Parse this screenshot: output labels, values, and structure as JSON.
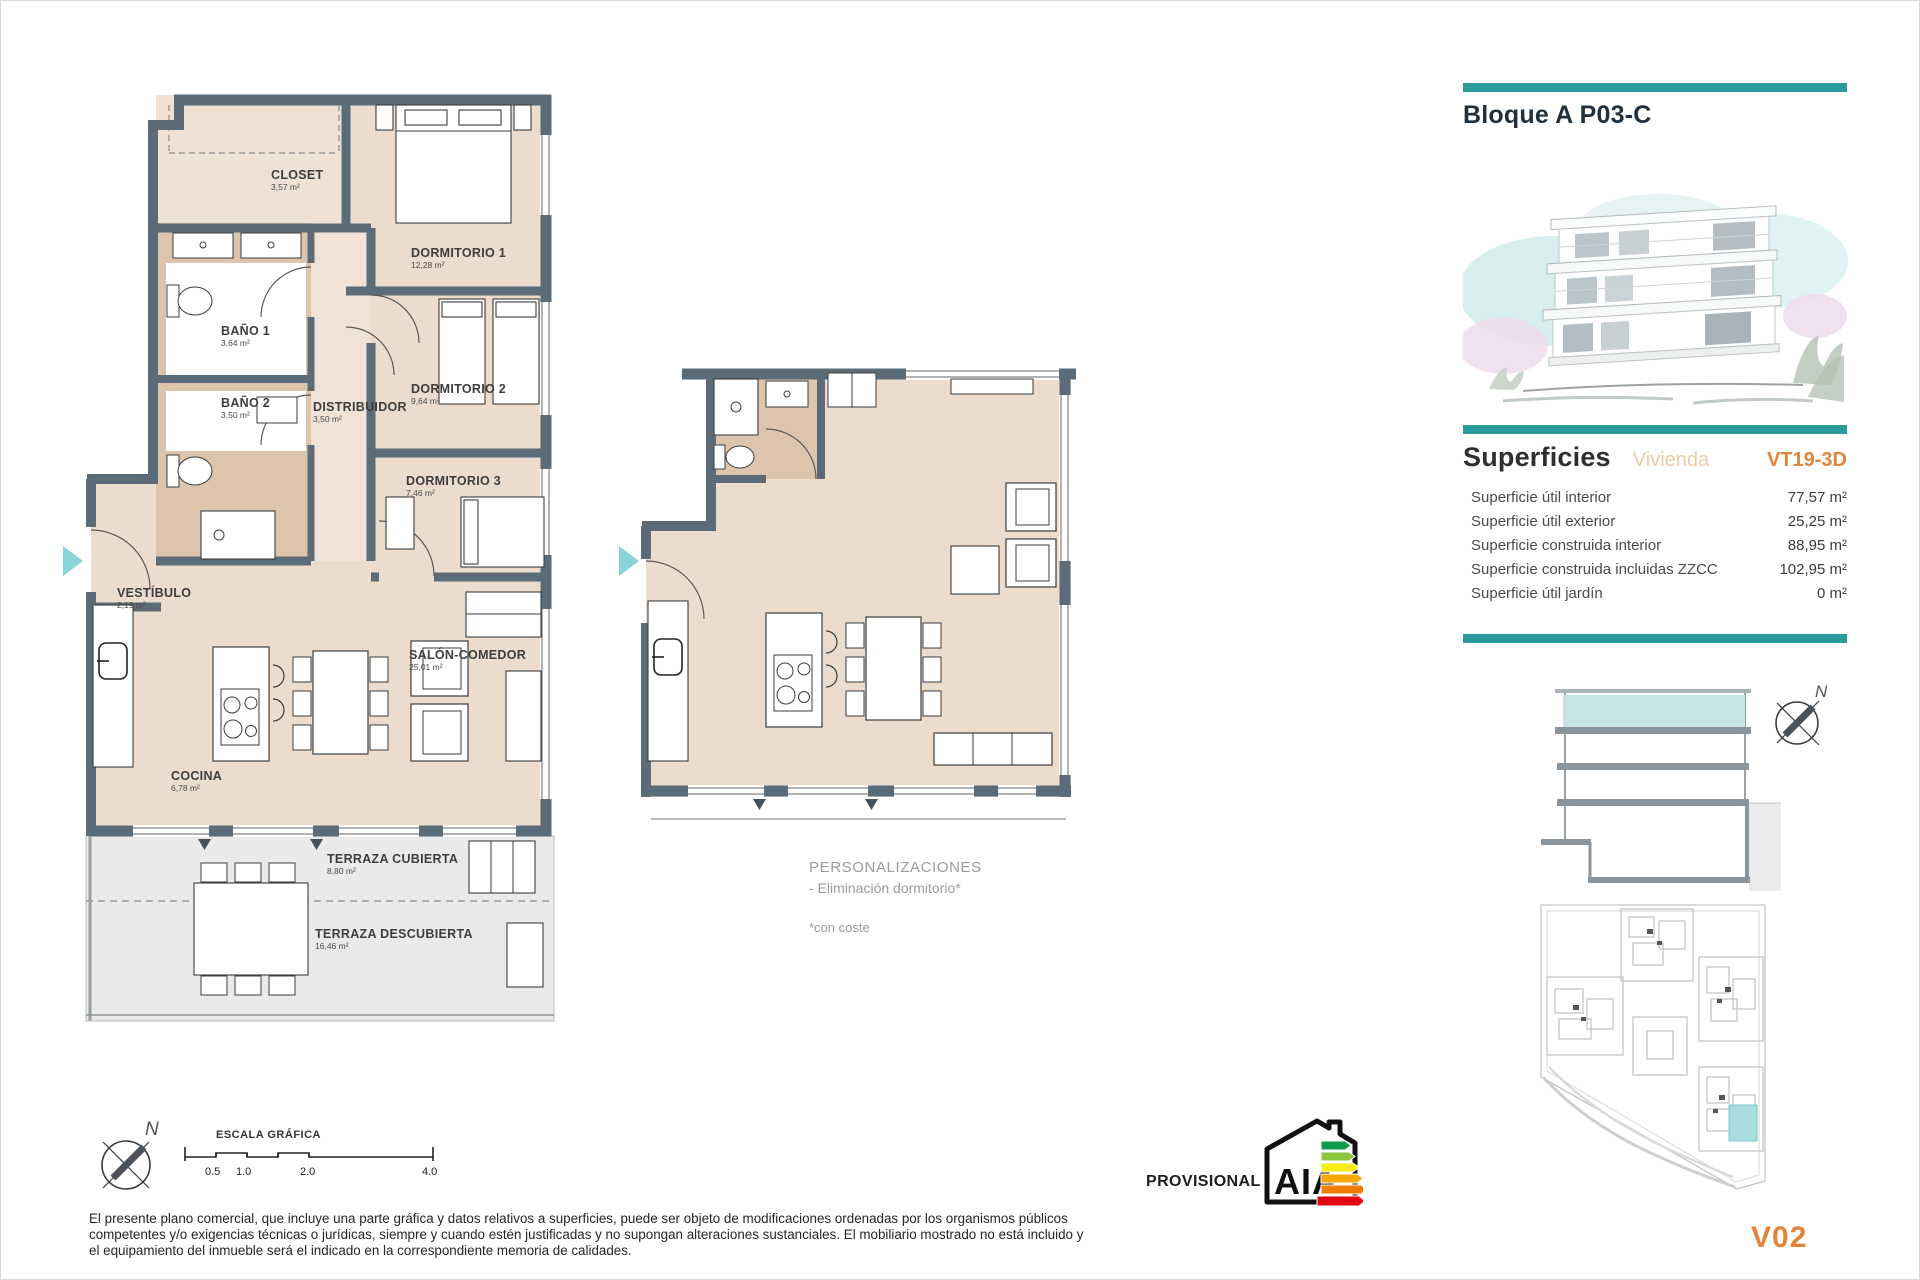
{
  "header": {
    "title": "Bloque A P03-C"
  },
  "superficies": {
    "title": "Superficies",
    "subtitle": "Vivienda",
    "code": "VT19-3D",
    "rows": [
      {
        "label": "Superficie útil interior",
        "value": "77,57 m²"
      },
      {
        "label": "Superficie útil exterior",
        "value": "25,25 m²"
      },
      {
        "label": "Superficie construida interior",
        "value": "88,95 m²"
      },
      {
        "label": "Superficie construida incluidas ZZCC",
        "value": "102,95 m²"
      },
      {
        "label": "Superficie útil jardín",
        "value": "0 m²"
      }
    ]
  },
  "plan": {
    "rooms": [
      {
        "name": "CLOSET",
        "area": "3,57 m²"
      },
      {
        "name": "DORMITORIO 1",
        "area": "12,28 m²"
      },
      {
        "name": "BAÑO 1",
        "area": "3,64 m²"
      },
      {
        "name": "BAÑO 2",
        "area": "3,50 m²"
      },
      {
        "name": "DISTRIBUIDOR",
        "area": "3,50 m²"
      },
      {
        "name": "DORMITORIO 2",
        "area": "9,64 m²"
      },
      {
        "name": "DORMITORIO 3",
        "area": "7,46 m²"
      },
      {
        "name": "VESTÍBULO",
        "area": "2,19 m²"
      },
      {
        "name": "SALÓN-COMEDOR",
        "area": "25,01 m²"
      },
      {
        "name": "COCINA",
        "area": "6,78 m²"
      },
      {
        "name": "TERRAZA CUBIERTA",
        "area": "8,80 m²"
      },
      {
        "name": "TERRAZA DESCUBIERTA",
        "area": "16,46 m²"
      }
    ]
  },
  "personalizaciones": {
    "title": "PERSONALIZACIONES",
    "option": "- Eliminación dormitorio*",
    "note": "*con coste"
  },
  "scale_bar": {
    "label": "ESCALA GRÁFICA",
    "ticks": [
      "0.5",
      "1.0",
      "2.0",
      "4.0"
    ]
  },
  "compass": {
    "north": "N"
  },
  "energy": {
    "letters": "AIA",
    "provisional": "PROVISIONAL"
  },
  "version": "V02",
  "disclaimer": "El presente plano comercial, que incluye una parte gráfica y datos relativos a superficies, puede ser objeto de modificaciones ordenadas por los organismos públicos competentes y/o exigencias técnicas o jurídicas, siempre y cuando estén justificadas y no supongan alteraciones sustanciales. El mobiliario mostrado no está incluido y el equipamiento del inmueble será el indicado en la correspondiente memoria de calidades.",
  "colors": {
    "teal_accent": "#2a9b9c",
    "orange_accent": "#e2853b",
    "wall": "#5b6b78",
    "floor_beige": "#ebdccd",
    "bath_tan": "#dcc4ad",
    "terrace_gray": "#e9eae9",
    "highlight_teal": "#c6e3e6",
    "entry_arrow": "#87d5d8"
  }
}
